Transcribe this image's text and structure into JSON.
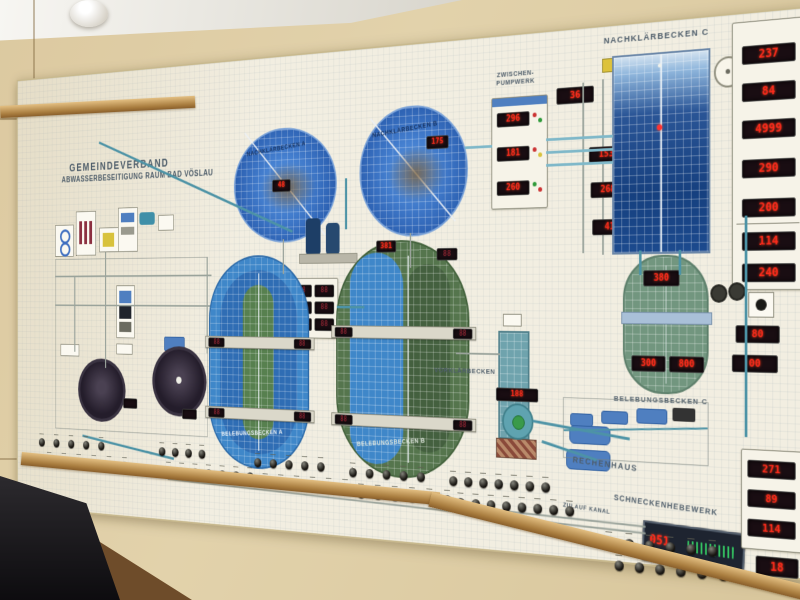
{
  "board": {
    "title_line1": "GEMEINDEVERBAND",
    "title_line2": "ABWASSERBESEITIGUNG RAUM BAD VÖSLAU",
    "labels": {
      "nachklaerbecken_a": "NACHKLÄRBECKEN A",
      "nachklaerbecken_b": "NACHKLÄRBECKEN B",
      "nachklaerbecken_c": "NACHKLÄRBECKEN C",
      "belebungsbecken_a": "BELEBUNGSBECKEN A",
      "belebungsbecken_b": "BELEBUNGSBECKEN B",
      "belebungsbecken_c": "BELEBUNGSBECKEN C",
      "vorklaerbecken": "VORKLÄRBECKEN",
      "zwischenpumpwerk": "ZWISCHEN-PUMPWERK",
      "rechenhaus": "RECHENHAUS",
      "schneckenhebewerk": "SCHNECKENHEBEWERK",
      "zulauf": "ZULAUF KANAL"
    },
    "displays": {
      "right_top": [
        "237",
        "84",
        "4999",
        "290",
        "200"
      ],
      "right_mid": [
        "114",
        "240"
      ],
      "right_pair": [
        "80",
        "00"
      ],
      "right_bottom": [
        "271",
        "89",
        "114"
      ],
      "mid_column": [
        "153",
        "268",
        "41"
      ],
      "pumpwerk": [
        "296",
        "181",
        "260"
      ],
      "pumpwerk_top": "36",
      "nkb_a": "48",
      "nkb_b": "175",
      "panel6": [
        "88",
        "88",
        "88",
        "88",
        "88",
        "88"
      ],
      "bba_bridge": [
        "88",
        "88",
        "88",
        "88"
      ],
      "bbb_bridge": [
        "88",
        "88",
        "88",
        "88"
      ],
      "bbb_top": [
        "381",
        "88"
      ],
      "bbc_top": "380",
      "bbc_bottom_left": "300",
      "bbc_bottom_right": "800",
      "sump": "188",
      "schnecke": "051",
      "corner": "18"
    },
    "colors": {
      "led_red": "#ff2b1c",
      "pipe_teal": "#4d93a6",
      "basin_blue": "#3f87c9",
      "basin_green": "#55754d",
      "clarifier_deep_blue": "#1c4587"
    }
  },
  "switches": {
    "groups": [
      {
        "x": 40,
        "y": 478,
        "rows": [
          5,
          6
        ],
        "gap": 27
      },
      {
        "x": 253,
        "y": 480,
        "rows": [
          4,
          7
        ],
        "gap": 22
      },
      {
        "x": 408,
        "y": 486,
        "rows": [
          5,
          6
        ],
        "gap": 24
      },
      {
        "x": 551,
        "y": 490,
        "rows": [
          5,
          6
        ],
        "gap": 24
      },
      {
        "x": 691,
        "y": 492,
        "rows": [
          7,
          8
        ],
        "gap": 20
      },
      {
        "x": 889,
        "y": 546,
        "rows": [
          6,
          6
        ],
        "gap": 24
      }
    ]
  }
}
